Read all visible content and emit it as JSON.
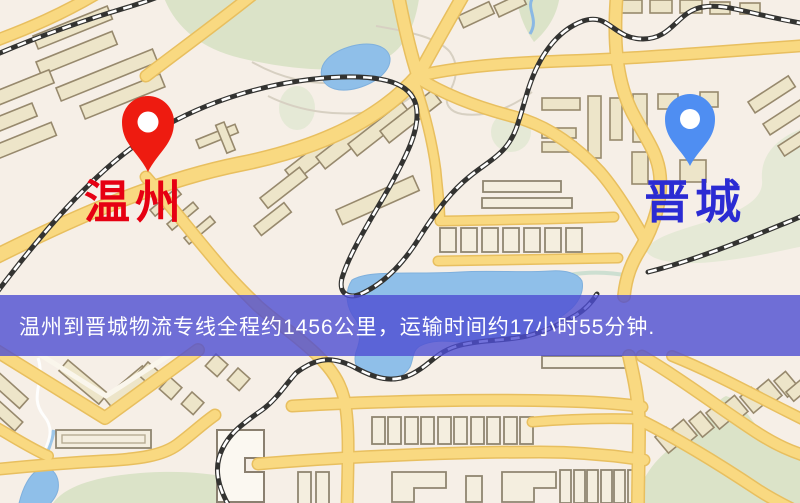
{
  "map": {
    "origin_marker": {
      "label": "温州",
      "pin_color": "#ee1b10",
      "label_color": "#e60012"
    },
    "destination_marker": {
      "label": "晋城",
      "pin_color": "#4f8ef2",
      "label_color": "#2b2bd3"
    },
    "palette": {
      "background": "#f6efe7",
      "road_fill": "#f9d981",
      "road_casing": "#e8bf5f",
      "water": "#8fbfe9",
      "park": "#dbe3c8",
      "building": "#ede5c9",
      "railway": "#333331"
    }
  },
  "banner": {
    "text": "温州到晋城物流专线全程约1456公里，运输时间约17小时55分钟.",
    "background_color": "#4d4dd2",
    "text_color": "#ffffff"
  }
}
